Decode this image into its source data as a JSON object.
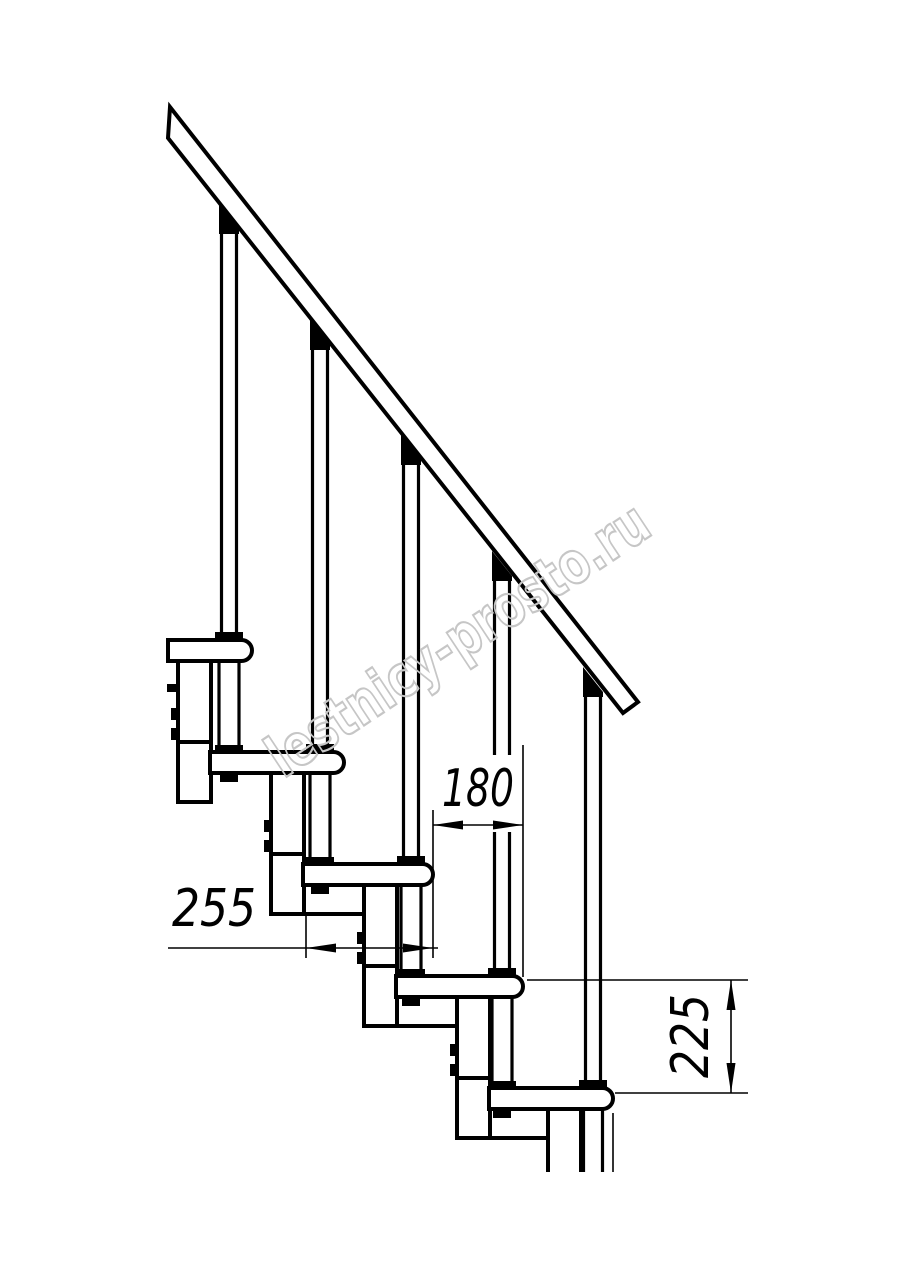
{
  "title": "Modular staircase side-view technical drawing",
  "dimensions": {
    "tread_overlap": {
      "value": "180",
      "orientation": "horizontal"
    },
    "step_depth": {
      "value": "255",
      "orientation": "horizontal"
    },
    "riser_height": {
      "value": "225",
      "orientation": "vertical"
    }
  },
  "watermark": {
    "text": "lestnicy-prosto.ru",
    "color": "#c6c6c6"
  },
  "colors": {
    "line": "#000000",
    "background": "#ffffff",
    "dimension_text": "#000000"
  }
}
